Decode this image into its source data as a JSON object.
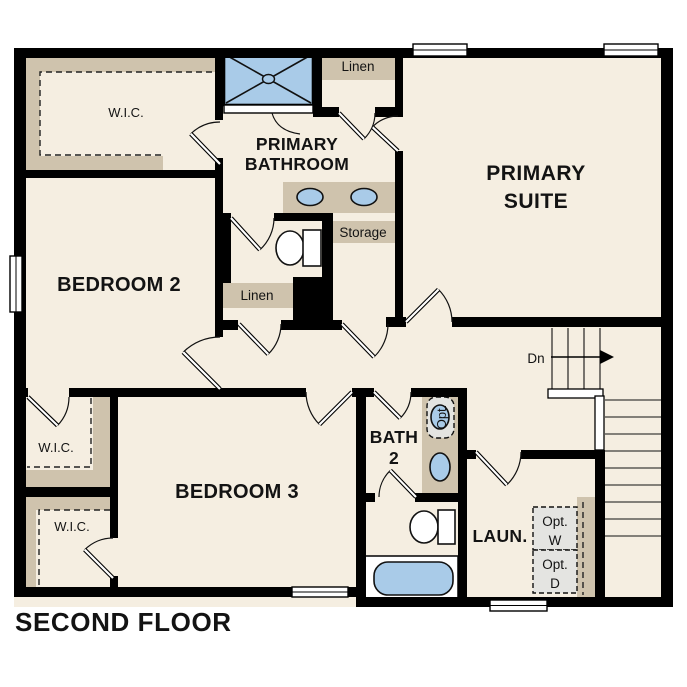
{
  "floor_plan": {
    "title": "SECOND FLOOR",
    "rooms": {
      "primary_suite": {
        "line1": "PRIMARY",
        "line2": "SUITE"
      },
      "primary_bathroom": {
        "line1": "PRIMARY",
        "line2": "BATHROOM"
      },
      "bedroom2": {
        "label": "BEDROOM 2"
      },
      "bedroom3": {
        "label": "BEDROOM 3"
      },
      "bath2": {
        "line1": "BATH",
        "line2": "2"
      },
      "laundry": {
        "label": "LAUN."
      },
      "wic_primary": {
        "label": "W.I.C."
      },
      "wic_bedroom2": {
        "label": "W.I.C."
      },
      "wic_bedroom3": {
        "label": "W.I.C."
      },
      "linen_upper": {
        "label": "Linen"
      },
      "linen_hall": {
        "label": "Linen"
      },
      "storage": {
        "label": "Storage"
      }
    },
    "annotations": {
      "stairs_down": "Dn",
      "optional_washer": {
        "line1": "Opt.",
        "line2": "W"
      },
      "optional_dryer": {
        "line1": "Opt.",
        "line2": "D"
      },
      "optional_sink": "Opt."
    },
    "colors": {
      "floor": "#f5eee1",
      "wall": "#000000",
      "cabinetry_tan": "#cfc3ad",
      "fixture_blue": "#a9cbe8",
      "optional_gray": "#e4e4e1",
      "background": "#ffffff"
    }
  }
}
